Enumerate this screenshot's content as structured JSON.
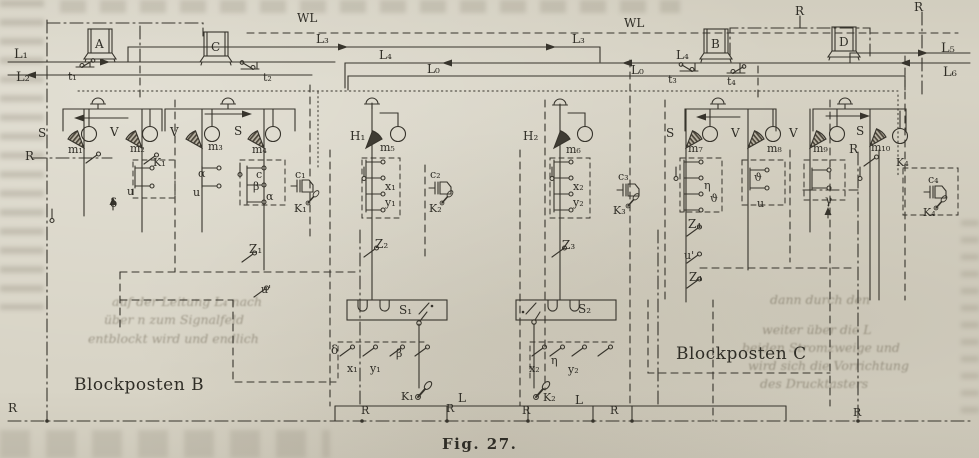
{
  "figure": {
    "caption": "Fig. 27.",
    "stations": {
      "left": "Blockposten B",
      "right": "Blockposten C"
    }
  },
  "colors": {
    "paper": "#d8d4c6",
    "ink": "#37342c",
    "bleed_ink": "#605844"
  },
  "diagram_labels": [
    {
      "t": "L₁",
      "x": 14,
      "y": 58,
      "s": 13
    },
    {
      "t": "L₂",
      "x": 16,
      "y": 81,
      "s": 13
    },
    {
      "t": "WL",
      "x": 297,
      "y": 22,
      "s": 12
    },
    {
      "t": "WL",
      "x": 624,
      "y": 27,
      "s": 12
    },
    {
      "t": "R",
      "x": 795,
      "y": 15,
      "s": 12
    },
    {
      "t": "R",
      "x": 914,
      "y": 11,
      "s": 12
    },
    {
      "t": "L₃",
      "x": 316,
      "y": 43,
      "s": 12
    },
    {
      "t": "L₃",
      "x": 572,
      "y": 43,
      "s": 12
    },
    {
      "t": "L₄",
      "x": 379,
      "y": 59,
      "s": 12
    },
    {
      "t": "L₄",
      "x": 676,
      "y": 59,
      "s": 12
    },
    {
      "t": "L₀",
      "x": 427,
      "y": 73,
      "s": 12
    },
    {
      "t": "L₀",
      "x": 631,
      "y": 74,
      "s": 12
    },
    {
      "t": "L₅",
      "x": 941,
      "y": 52,
      "s": 13
    },
    {
      "t": "L₆",
      "x": 943,
      "y": 76,
      "s": 13
    },
    {
      "t": "A",
      "x": 95,
      "y": 48,
      "s": 12
    },
    {
      "t": "C",
      "x": 211,
      "y": 51,
      "s": 12
    },
    {
      "t": "B",
      "x": 711,
      "y": 48,
      "s": 12
    },
    {
      "t": "D",
      "x": 839,
      "y": 46,
      "s": 12
    },
    {
      "t": "t₁",
      "x": 68,
      "y": 80,
      "s": 11
    },
    {
      "t": "t₂",
      "x": 263,
      "y": 81,
      "s": 11
    },
    {
      "t": "t₃",
      "x": 668,
      "y": 83,
      "s": 11
    },
    {
      "t": "t₄",
      "x": 727,
      "y": 85,
      "s": 11
    },
    {
      "t": "S",
      "x": 38,
      "y": 137,
      "s": 12
    },
    {
      "t": "m₁",
      "x": 68,
      "y": 153,
      "s": 11
    },
    {
      "t": "V",
      "x": 110,
      "y": 136,
      "s": 12
    },
    {
      "t": "m₂",
      "x": 130,
      "y": 152,
      "s": 11
    },
    {
      "t": "V",
      "x": 170,
      "y": 136,
      "s": 12
    },
    {
      "t": "m₃",
      "x": 208,
      "y": 150,
      "s": 11
    },
    {
      "t": "S",
      "x": 234,
      "y": 135,
      "s": 12
    },
    {
      "t": "m₄",
      "x": 252,
      "y": 153,
      "s": 11
    },
    {
      "t": "H₁",
      "x": 350,
      "y": 140,
      "s": 12
    },
    {
      "t": "m₅",
      "x": 380,
      "y": 151,
      "s": 11
    },
    {
      "t": "H₂",
      "x": 523,
      "y": 140,
      "s": 12
    },
    {
      "t": "m₆",
      "x": 566,
      "y": 153,
      "s": 11
    },
    {
      "t": "S",
      "x": 666,
      "y": 137,
      "s": 12
    },
    {
      "t": "m₇",
      "x": 688,
      "y": 152,
      "s": 11
    },
    {
      "t": "V",
      "x": 731,
      "y": 137,
      "s": 12
    },
    {
      "t": "m₈",
      "x": 767,
      "y": 152,
      "s": 11
    },
    {
      "t": "V",
      "x": 789,
      "y": 137,
      "s": 12
    },
    {
      "t": "m₉",
      "x": 813,
      "y": 152,
      "s": 11
    },
    {
      "t": "S",
      "x": 856,
      "y": 135,
      "s": 12
    },
    {
      "t": "m₁₀",
      "x": 871,
      "y": 151,
      "s": 11
    },
    {
      "t": "R",
      "x": 25,
      "y": 160,
      "s": 12
    },
    {
      "t": "K₁",
      "x": 153,
      "y": 166,
      "s": 11
    },
    {
      "t": "R",
      "x": 849,
      "y": 153,
      "s": 12
    },
    {
      "t": "K₄",
      "x": 896,
      "y": 166,
      "s": 11
    },
    {
      "t": "δ",
      "x": 110,
      "y": 207,
      "s": 12
    },
    {
      "t": "u",
      "x": 127,
      "y": 195,
      "s": 11
    },
    {
      "t": "α",
      "x": 198,
      "y": 177,
      "s": 11
    },
    {
      "t": "u",
      "x": 193,
      "y": 196,
      "s": 11
    },
    {
      "t": "c",
      "x": 256,
      "y": 178,
      "s": 11
    },
    {
      "t": "β",
      "x": 253,
      "y": 190,
      "s": 11
    },
    {
      "t": "α",
      "x": 266,
      "y": 200,
      "s": 11
    },
    {
      "t": "c₁",
      "x": 295,
      "y": 178,
      "s": 11
    },
    {
      "t": "K₁",
      "x": 294,
      "y": 212,
      "s": 11
    },
    {
      "t": "Z₁",
      "x": 249,
      "y": 253,
      "s": 12
    },
    {
      "t": "u'",
      "x": 261,
      "y": 293,
      "s": 11
    },
    {
      "t": "x₁",
      "x": 385,
      "y": 190,
      "s": 11
    },
    {
      "t": "y₁",
      "x": 385,
      "y": 206,
      "s": 11
    },
    {
      "t": "Z₂",
      "x": 375,
      "y": 248,
      "s": 12
    },
    {
      "t": "c₂",
      "x": 430,
      "y": 178,
      "s": 11
    },
    {
      "t": "K₂",
      "x": 429,
      "y": 212,
      "s": 11
    },
    {
      "t": "x₂",
      "x": 573,
      "y": 190,
      "s": 11
    },
    {
      "t": "y₂",
      "x": 573,
      "y": 206,
      "s": 11
    },
    {
      "t": "Z₃",
      "x": 562,
      "y": 249,
      "s": 12
    },
    {
      "t": "c₃",
      "x": 618,
      "y": 180,
      "s": 11
    },
    {
      "t": "K₃",
      "x": 613,
      "y": 214,
      "s": 11
    },
    {
      "t": "η",
      "x": 704,
      "y": 189,
      "s": 11
    },
    {
      "t": "ϑ",
      "x": 710,
      "y": 202,
      "s": 11
    },
    {
      "t": "Z₄",
      "x": 688,
      "y": 228,
      "s": 12
    },
    {
      "t": "u'",
      "x": 684,
      "y": 259,
      "s": 11
    },
    {
      "t": "Z₄",
      "x": 689,
      "y": 281,
      "s": 12
    },
    {
      "t": "ϑ",
      "x": 754,
      "y": 181,
      "s": 11
    },
    {
      "t": "u",
      "x": 757,
      "y": 207,
      "s": 11
    },
    {
      "t": "γ",
      "x": 825,
      "y": 204,
      "s": 12
    },
    {
      "t": "c₄",
      "x": 928,
      "y": 183,
      "s": 11
    },
    {
      "t": "K₄",
      "x": 923,
      "y": 216,
      "s": 11
    },
    {
      "t": "S₁",
      "x": 399,
      "y": 314,
      "s": 12
    },
    {
      "t": "S₂",
      "x": 578,
      "y": 313,
      "s": 12
    },
    {
      "t": "δ",
      "x": 331,
      "y": 354,
      "s": 12
    },
    {
      "t": "x₁",
      "x": 347,
      "y": 372,
      "s": 11
    },
    {
      "t": "y₁",
      "x": 370,
      "y": 372,
      "s": 11
    },
    {
      "t": "β",
      "x": 396,
      "y": 357,
      "s": 11
    },
    {
      "t": "K₁",
      "x": 401,
      "y": 400,
      "s": 11
    },
    {
      "t": "L",
      "x": 458,
      "y": 402,
      "s": 12
    },
    {
      "t": "x₂",
      "x": 529,
      "y": 372,
      "s": 11
    },
    {
      "t": "η",
      "x": 551,
      "y": 364,
      "s": 11
    },
    {
      "t": "y₂",
      "x": 568,
      "y": 373,
      "s": 11
    },
    {
      "t": "K₂",
      "x": 543,
      "y": 401,
      "s": 11
    },
    {
      "t": "L",
      "x": 575,
      "y": 404,
      "s": 12
    },
    {
      "t": "R",
      "x": 8,
      "y": 412,
      "s": 12
    },
    {
      "t": "R",
      "x": 361,
      "y": 414,
      "s": 11
    },
    {
      "t": "R",
      "x": 446,
      "y": 412,
      "s": 11
    },
    {
      "t": "R",
      "x": 522,
      "y": 414,
      "s": 11
    },
    {
      "t": "R",
      "x": 610,
      "y": 414,
      "s": 11
    },
    {
      "t": "R",
      "x": 853,
      "y": 416,
      "s": 11
    }
  ],
  "bleed_text": [
    {
      "t": "auf der Leitung L₄ nach",
      "x": 112,
      "y": 294
    },
    {
      "t": "über n zum Signalfeld",
      "x": 104,
      "y": 312
    },
    {
      "t": "entblockt wird und endlich",
      "x": 88,
      "y": 331
    },
    {
      "t": "dann durch den",
      "x": 770,
      "y": 292
    },
    {
      "t": "weiter über die L",
      "x": 762,
      "y": 322
    },
    {
      "t": "beiden Stromzweige und",
      "x": 742,
      "y": 340
    },
    {
      "t": "wird sich die Vorrichtung",
      "x": 748,
      "y": 358
    },
    {
      "t": "des Drucktasters",
      "x": 760,
      "y": 376
    }
  ]
}
